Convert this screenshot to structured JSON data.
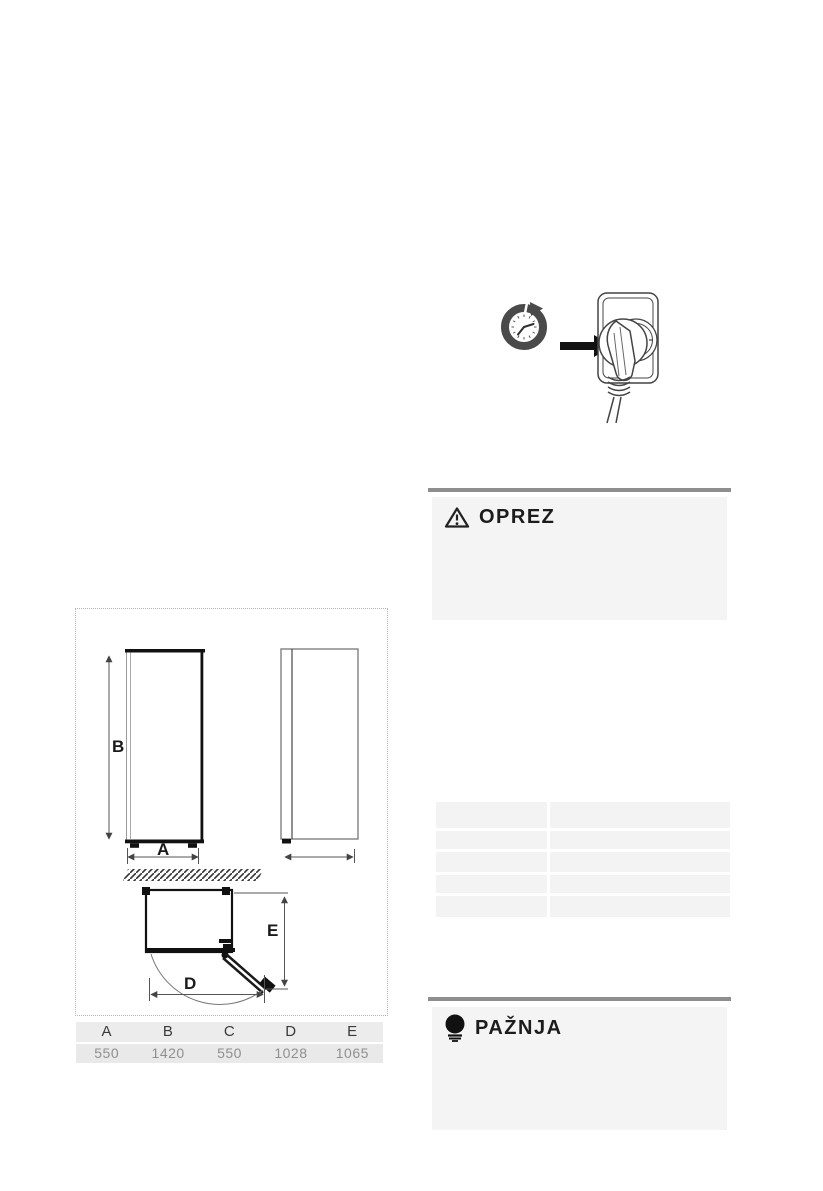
{
  "page": {
    "background": "#ffffff"
  },
  "timer_plug_figure": {
    "clock_icon": "clock-timer-icon",
    "arrow_icon": "arrow-right-icon",
    "socket_icon": "plug-in-socket-icon"
  },
  "caution_box": {
    "title": "OPREZ",
    "icon": "warning-triangle-icon",
    "bar_color": "#8e8e8e",
    "background": "#f4f4f4"
  },
  "attention_box": {
    "title": "PAŽNJA",
    "icon": "lightbulb-icon",
    "bar_color": "#8e8e8e",
    "background": "#f4f4f4"
  },
  "dimensions_figure": {
    "labels": {
      "height": "B",
      "width": "A",
      "depth_door_open": "E",
      "width_door_open": "D"
    }
  },
  "dimensions_table": {
    "headers": [
      "A",
      "B",
      "C",
      "D",
      "E"
    ],
    "values": [
      "550",
      "1420",
      "550",
      "1028",
      "1065"
    ]
  },
  "spec_table": {
    "rows": 5,
    "columns": 2
  }
}
